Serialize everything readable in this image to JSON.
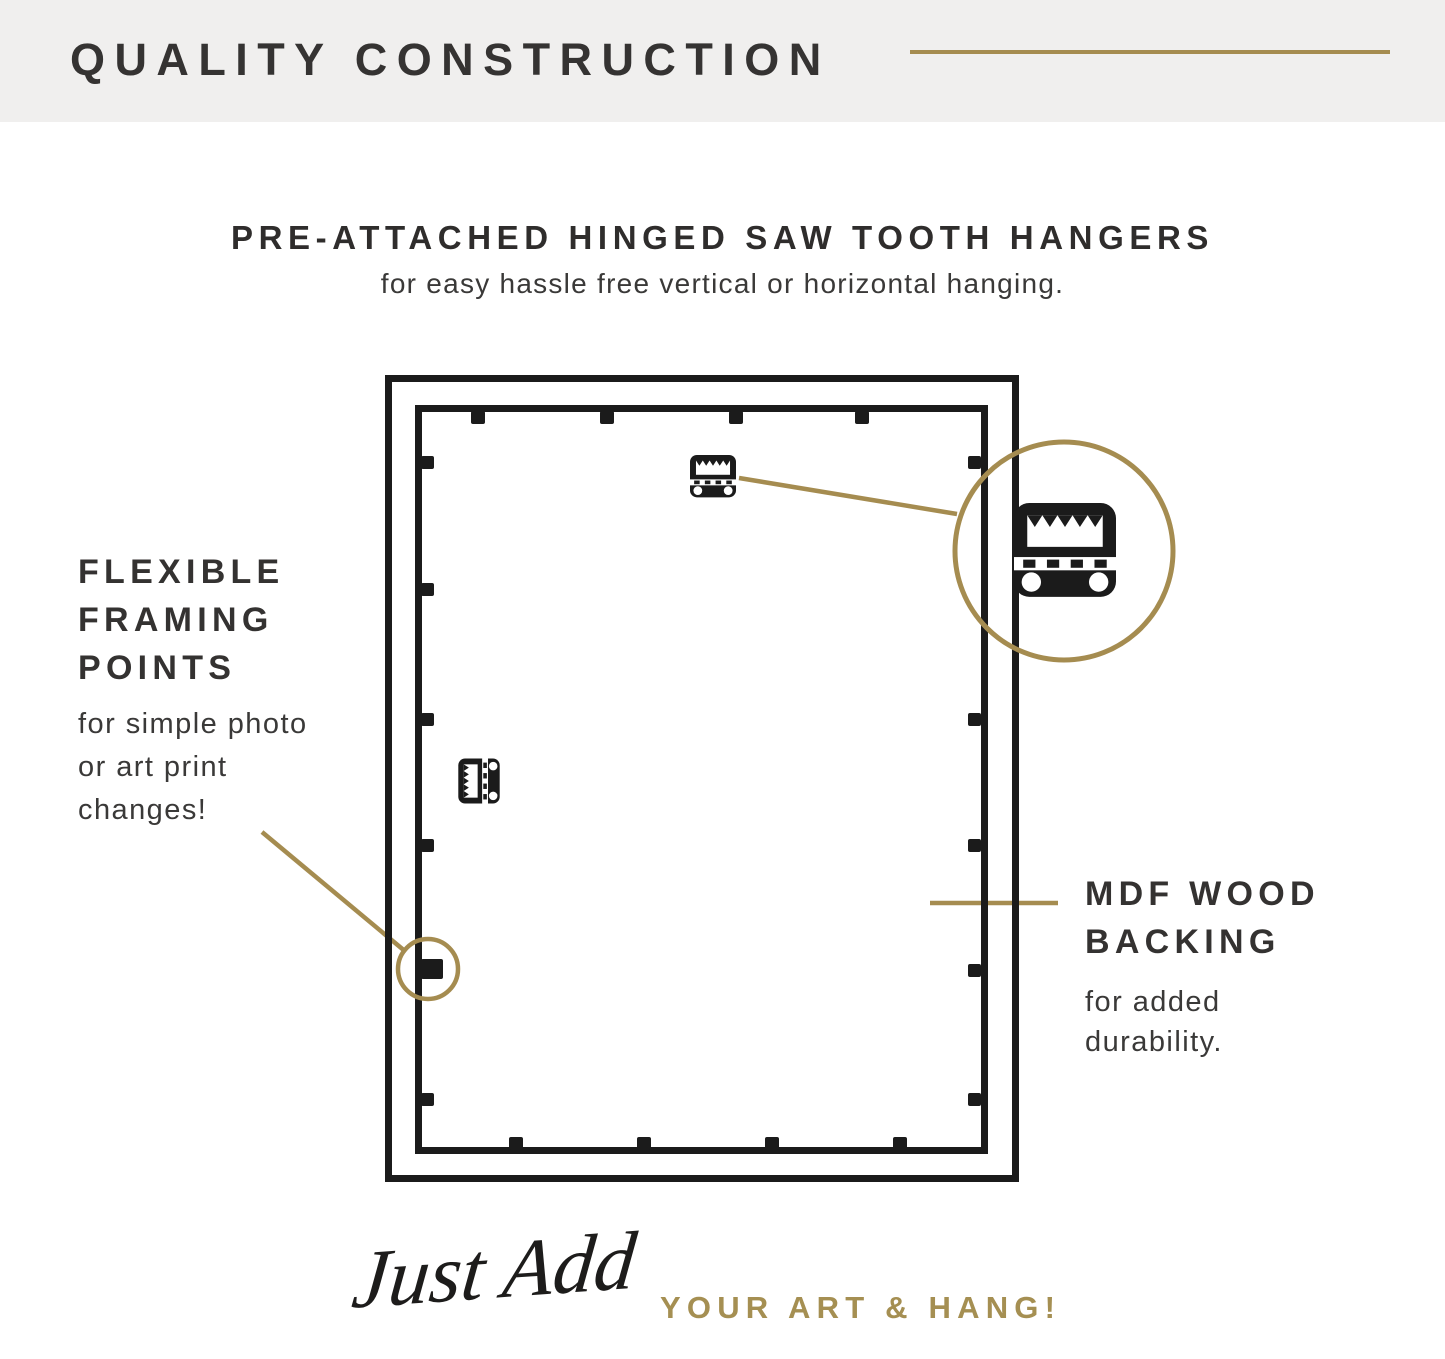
{
  "header": {
    "title": "QUALITY CONSTRUCTION"
  },
  "hero": {
    "title": "PRE-ATTACHED HINGED SAW TOOTH HANGERS",
    "subtitle": "for easy hassle free vertical or horizontal hanging."
  },
  "callouts": {
    "flexible_framing_points": {
      "title_lines": [
        "FLEXIBLE",
        "FRAMING",
        "POINTS"
      ],
      "body_lines": [
        "for simple photo",
        "or art print",
        "changes!"
      ]
    },
    "mdf_wood_backing": {
      "title_lines": [
        "MDF WOOD",
        "BACKING"
      ],
      "body_lines": [
        "for added",
        "durability."
      ]
    }
  },
  "tagline": {
    "script_text": "Just Add",
    "caps_text": "YOUR ART & HANG!"
  },
  "icons": {
    "sawtooth_hanger": "sawtooth-hanger-icon (black rounded square, sawtooth window, hinge strip, two screw holes)",
    "magnifier_circle": "gold detail circle",
    "framing_point": "small black tab on backing edge"
  },
  "colors": {
    "gold_accent": "#a58c50",
    "heading_ink": "#353332",
    "body_text": "#3a3938",
    "line_black": "#1b1b1b",
    "band_gray": "#f0efee",
    "background": "#ffffff"
  }
}
